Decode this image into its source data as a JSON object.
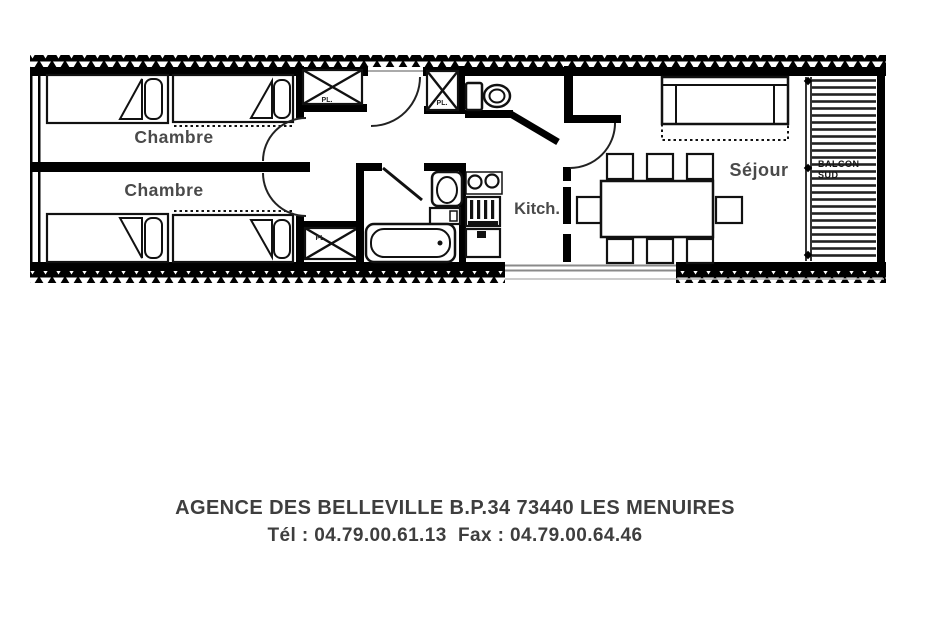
{
  "page": {
    "background_color": "#ffffff"
  },
  "floor_plan": {
    "labels": {
      "bedroom_top": "Chambre",
      "bedroom_bottom": "Chambre",
      "kitchen": "Kitch.",
      "living_room": "Séjour",
      "balcony_line1": "BALCON",
      "balcony_line2": "SUD",
      "closet_top_left": "PL.",
      "closet_top_right": "PL.",
      "closet_bottom": "PL."
    },
    "colors": {
      "walls": "#000000",
      "room_labels": "#4a4a4a",
      "window_line": "#8a8a8a"
    }
  },
  "footer": {
    "line1": "AGENCE DES BELLEVILLE B.P.34 73440 LES MENUIRES",
    "line2": "Tél : 04.79.00.61.13  Fax : 04.79.00.64.46"
  }
}
